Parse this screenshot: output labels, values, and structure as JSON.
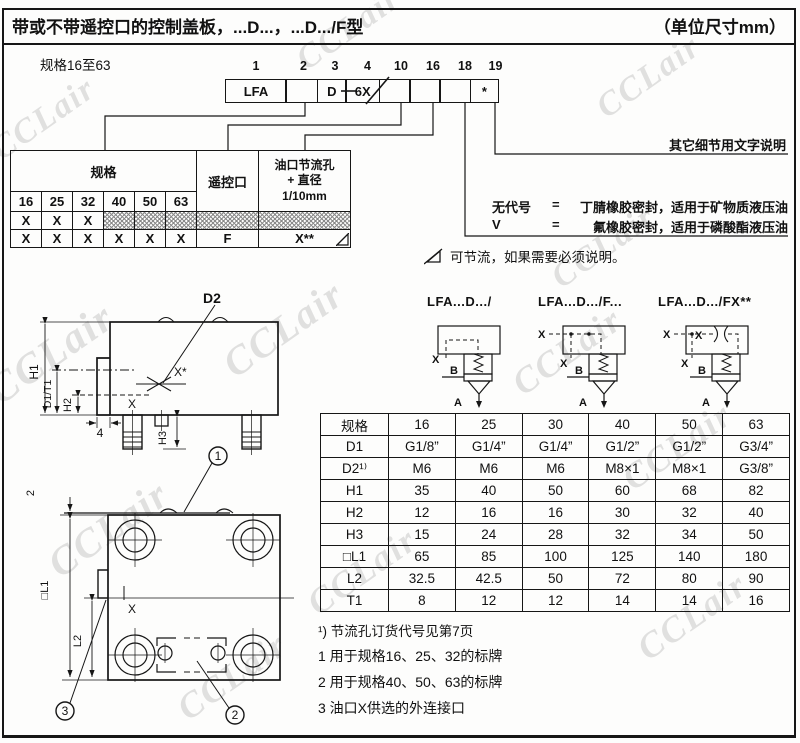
{
  "header": {
    "title": "带或不带遥控口的控制盖板，...D...，...D.../F型",
    "units": "（单位尺寸mm）"
  },
  "range_label": "规格16至63",
  "order_code": {
    "positions": [
      "1",
      "2",
      "3",
      "4",
      "10",
      "16",
      "18",
      "19"
    ],
    "boxes": [
      "LFA",
      "",
      "D",
      "6X",
      "",
      "",
      "",
      "*"
    ]
  },
  "selector_table": {
    "size_header": "规格",
    "remote_header": "遥控口",
    "orifice_header": [
      "油口节流孔",
      "+ 直径",
      "1/10mm"
    ],
    "sizes": [
      "16",
      "25",
      "32",
      "40",
      "50",
      "63"
    ],
    "row1": [
      "X",
      "X",
      "X"
    ],
    "row2": [
      "X",
      "X",
      "X",
      "X",
      "X",
      "X"
    ],
    "remote_value": "F",
    "orifice_value": "X**"
  },
  "seal_block": {
    "detail_note": "其它细节用文字说明",
    "rows": [
      {
        "code": "无代号",
        "eq": "=",
        "desc": "丁腈橡胶密封，适用于矿物质液压油"
      },
      {
        "code": "V",
        "eq": "=",
        "desc": "氟橡胶密封，适用于磷酸酯液压油"
      }
    ]
  },
  "throttle_note": "可节流，如果需要必须说明。",
  "symbols": {
    "s1": "LFA...D.../",
    "s2": "LFA...D.../F...",
    "s3": "LFA...D.../FX**",
    "x": "X",
    "a": "A",
    "b": "B"
  },
  "dim_table": {
    "header_label": "规格",
    "header_values": [
      "16",
      "25",
      "30",
      "40",
      "50",
      "63"
    ],
    "rows": [
      {
        "label": "D1",
        "values": [
          "G1/8”",
          "G1/4”",
          "G1/4”",
          "G1/2”",
          "G1/2”",
          "G3/4”"
        ]
      },
      {
        "label": "D2¹⁾",
        "values": [
          "M6",
          "M6",
          "M6",
          "M8×1",
          "M8×1",
          "G3/8”"
        ]
      },
      {
        "label": "H1",
        "values": [
          "35",
          "40",
          "50",
          "60",
          "68",
          "82"
        ]
      },
      {
        "label": "H2",
        "values": [
          "12",
          "16",
          "16",
          "30",
          "32",
          "40"
        ]
      },
      {
        "label": "H3",
        "values": [
          "15",
          "24",
          "28",
          "32",
          "34",
          "50"
        ]
      },
      {
        "label": "□L1",
        "values": [
          "65",
          "85",
          "100",
          "125",
          "140",
          "180"
        ]
      },
      {
        "label": "L2",
        "values": [
          "32.5",
          "42.5",
          "50",
          "72",
          "80",
          "90"
        ]
      },
      {
        "label": "T1",
        "values": [
          "8",
          "12",
          "12",
          "14",
          "14",
          "16"
        ]
      }
    ]
  },
  "footnote": "¹) 节流孔订货代号见第7页",
  "notes": [
    "1 用于规格16、25、32的标牌",
    "2 用于规格40、50、63的标牌",
    "3 油口X供选的外连接口"
  ],
  "drawing": {
    "d2": "D2",
    "xstar": "X*",
    "x": "X",
    "h1": "H1",
    "d1t1": "D1/T1",
    "h2": "H2",
    "h3": "H3",
    "four": "4",
    "two": "2",
    "l1": "□L1",
    "l2": "L2",
    "n1": "1",
    "n2": "2",
    "n3": "3"
  },
  "watermark": "CCLair"
}
